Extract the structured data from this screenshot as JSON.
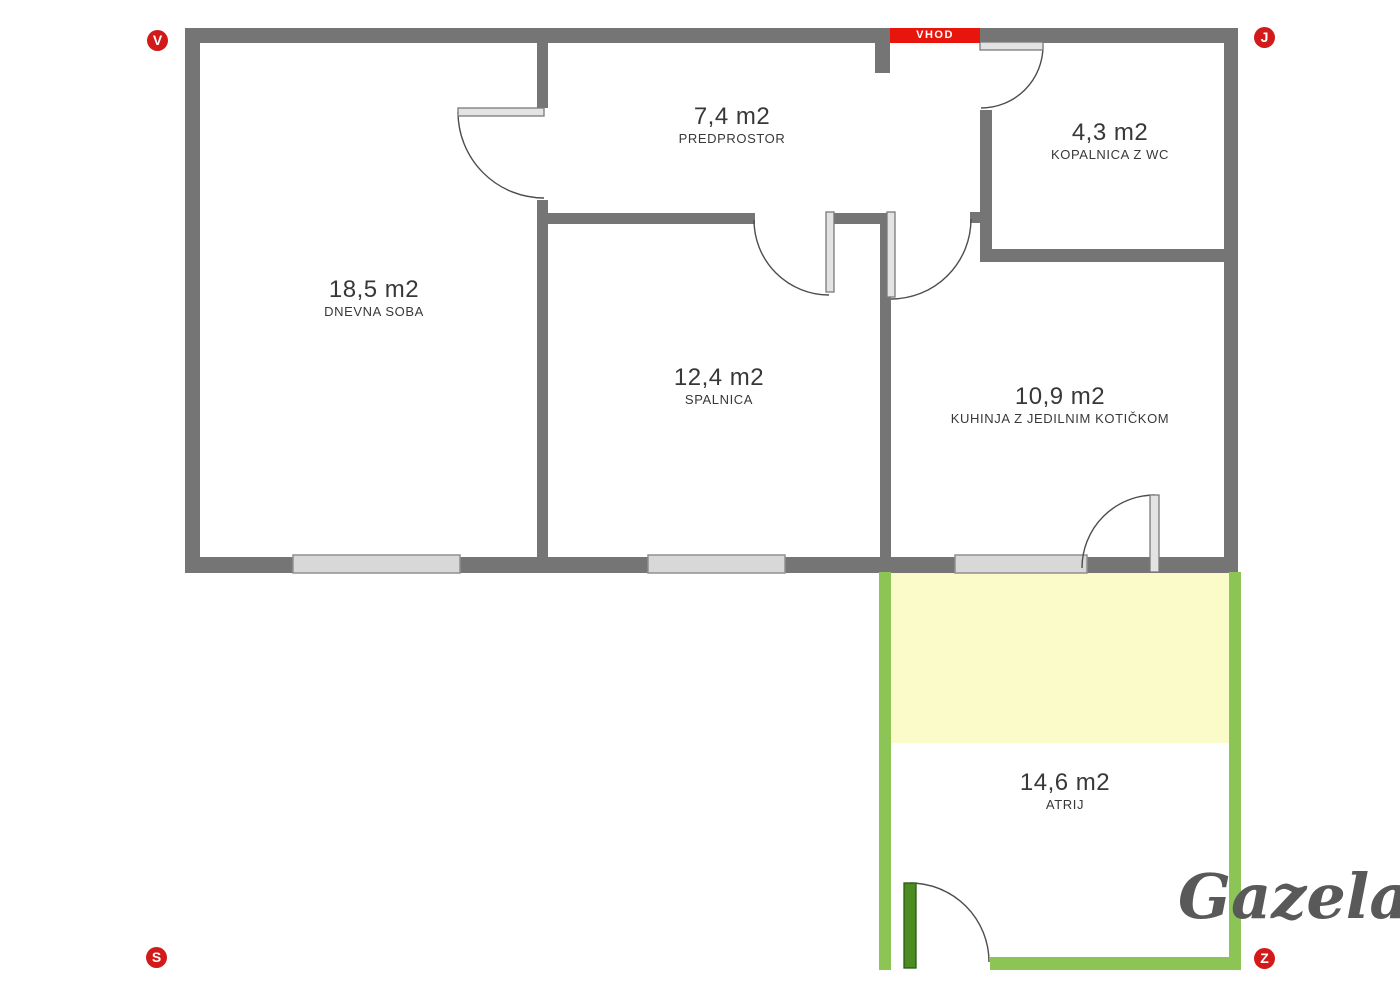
{
  "entrance": {
    "label": "VHOD"
  },
  "compass": {
    "top_left": "V",
    "top_right": "J",
    "bottom_left": "S",
    "bottom_right": "Z"
  },
  "watermark": "Gazela",
  "rooms": [
    {
      "area": "18,5 m2",
      "name": "DNEVNA SOBA"
    },
    {
      "area": "7,4 m2",
      "name": "PREDPROSTOR"
    },
    {
      "area": "4,3 m2",
      "name": "KOPALNICA Z WC"
    },
    {
      "area": "12,4 m2",
      "name": "SPALNICA"
    },
    {
      "area": "10,9 m2",
      "name": "KUHINJA Z JEDILNIM KOTIČKOM"
    },
    {
      "area": "14,6 m2",
      "name": "ATRIJ"
    }
  ],
  "colors": {
    "wall": "#757575",
    "atrium_wall": "#8cc455",
    "atrium_door": "#4c8c22",
    "atrium_highlight": "#fafbc8",
    "entrance_red": "#e8150d",
    "compass_red": "#d31a1a",
    "window_fill": "#d8d8d8",
    "text": "#383838",
    "watermark_gray": "#595959"
  }
}
